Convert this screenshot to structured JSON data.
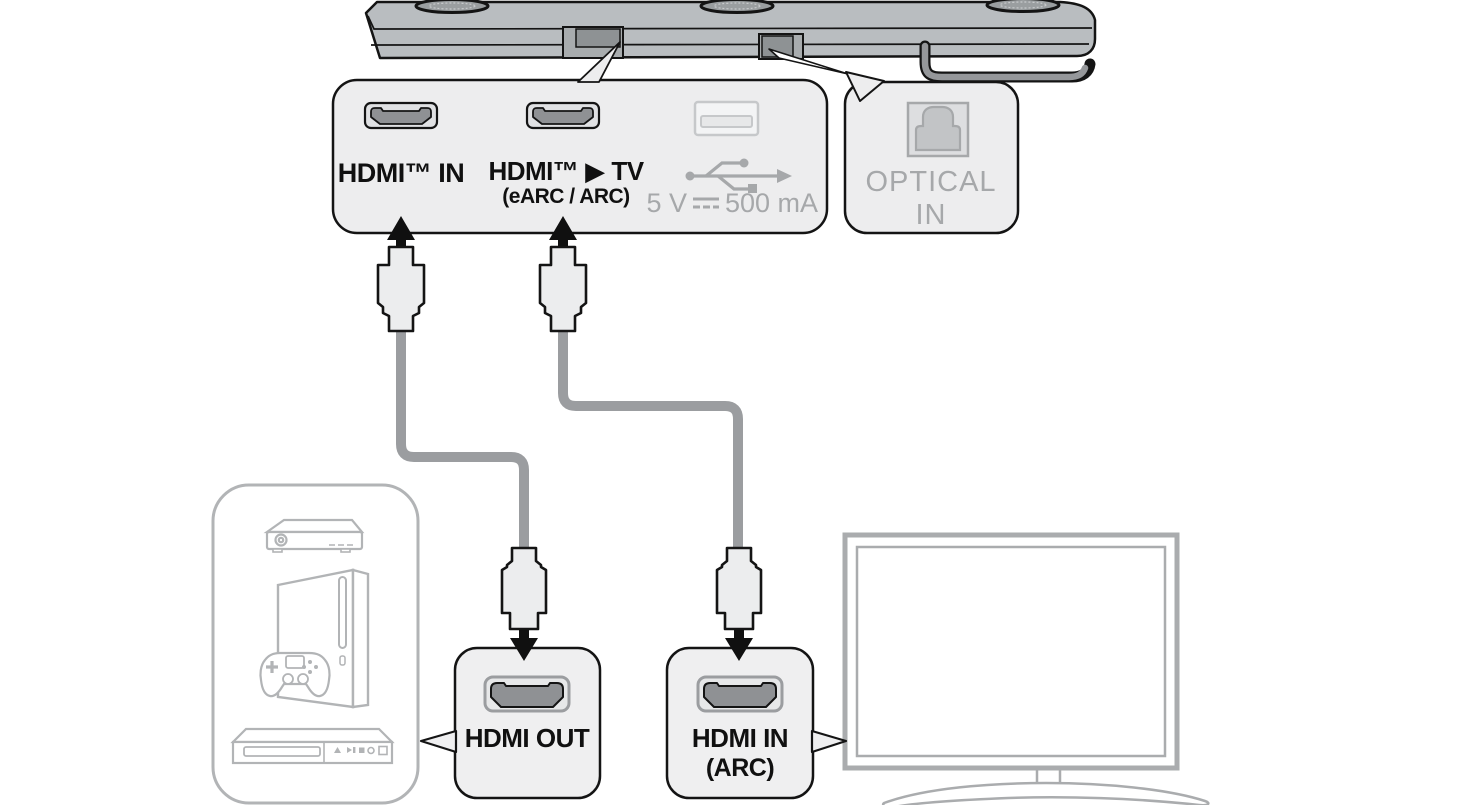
{
  "colors": {
    "outline": "#141414",
    "panel_fill": "#ededee",
    "soundbar_fill": "#b9bdc0",
    "cable_gray": "#9b9da0",
    "muted_text": "#a6a8aa",
    "device_icon_gray": "#b2b4b6",
    "hdmi_port_dark": "#8f9194",
    "tv_frame_gray": "#aaacae"
  },
  "soundbar_panel": {
    "hdmi_in_label": "HDMI™ IN",
    "hdmi_tv_label": "HDMI™ ▶ TV",
    "hdmi_tv_sublabel": "(eARC / ARC)",
    "usb_voltage": "5 V",
    "usb_current": "500 mA"
  },
  "optical_panel": {
    "line1": "OPTICAL",
    "line2": "IN"
  },
  "hdmi_out_box": {
    "label": "HDMI OUT"
  },
  "hdmi_in_arc_box": {
    "line1": "HDMI IN",
    "line2": "(ARC)"
  }
}
